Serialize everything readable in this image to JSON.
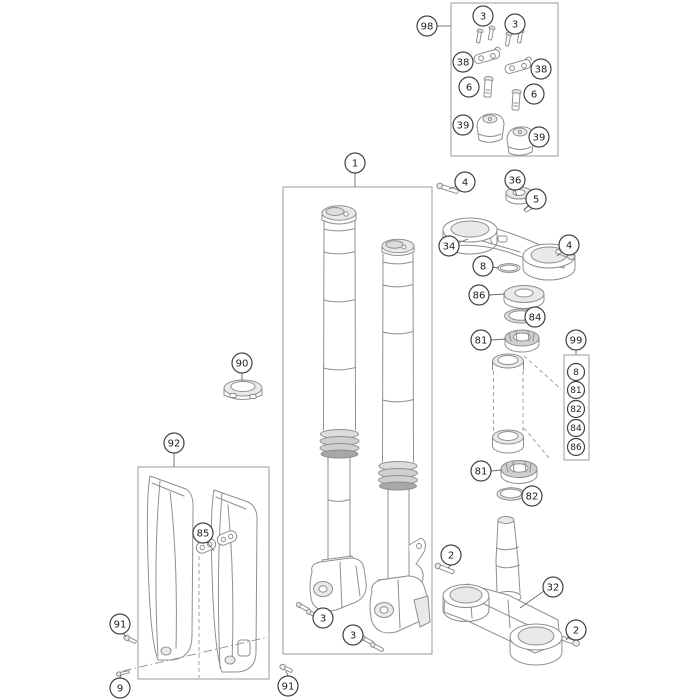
{
  "diagram": {
    "description": "Exploded spare-parts drawing: telescopic front fork, triple clamps, steering-head bearings, handlebar clamp kit and fork protectors",
    "background": "#ffffff",
    "palette": {
      "part_line": "#8f8f8f",
      "box_line": "#9b9b9b",
      "callout_stroke": "#414141",
      "callout_fill": "#ffffff",
      "text": "#1d1d1d",
      "shade_light": "#e9e9e9",
      "shade_mid": "#d0d0d0",
      "shade_dark": "#a7a7a7"
    },
    "group_boxes": [
      {
        "name": "handlebar-clamp-kit-box",
        "x": 451,
        "y": 3,
        "w": 107,
        "h": 153
      },
      {
        "name": "fork-assembly-box",
        "x": 283,
        "y": 187,
        "w": 149,
        "h": 467
      },
      {
        "name": "fork-protector-kit-box",
        "x": 138,
        "y": 467,
        "w": 131,
        "h": 212
      },
      {
        "name": "steering-bearing-kit-box",
        "x": 564,
        "y": 355,
        "w": 25,
        "h": 105
      }
    ],
    "callouts": [
      {
        "label": "98",
        "x": 427,
        "y": 26,
        "r": 10
      },
      {
        "label": "3",
        "x": 483,
        "y": 16,
        "r": 10
      },
      {
        "label": "3",
        "x": 515,
        "y": 24,
        "r": 10
      },
      {
        "label": "38",
        "x": 463,
        "y": 62,
        "r": 10
      },
      {
        "label": "38",
        "x": 541,
        "y": 69,
        "r": 10
      },
      {
        "label": "6",
        "x": 469,
        "y": 87,
        "r": 10
      },
      {
        "label": "6",
        "x": 534,
        "y": 94,
        "r": 10
      },
      {
        "label": "39",
        "x": 463,
        "y": 125,
        "r": 10
      },
      {
        "label": "39",
        "x": 539,
        "y": 137,
        "r": 10
      },
      {
        "label": "1",
        "x": 355,
        "y": 163,
        "r": 10
      },
      {
        "label": "4",
        "x": 465,
        "y": 182,
        "r": 10
      },
      {
        "label": "36",
        "x": 515,
        "y": 180,
        "r": 10
      },
      {
        "label": "5",
        "x": 536,
        "y": 199,
        "r": 10
      },
      {
        "label": "34",
        "x": 449,
        "y": 246,
        "r": 10
      },
      {
        "label": "4",
        "x": 569,
        "y": 245,
        "r": 10
      },
      {
        "label": "8",
        "x": 483,
        "y": 266,
        "r": 10
      },
      {
        "label": "86",
        "x": 479,
        "y": 295,
        "r": 10
      },
      {
        "label": "84",
        "x": 535,
        "y": 317,
        "r": 10
      },
      {
        "label": "81",
        "x": 481,
        "y": 340,
        "r": 10
      },
      {
        "label": "99",
        "x": 576,
        "y": 340,
        "r": 10
      },
      {
        "label": "8",
        "x": 576,
        "y": 372,
        "r": 8.5
      },
      {
        "label": "81",
        "x": 576,
        "y": 390,
        "r": 8.5
      },
      {
        "label": "82",
        "x": 576,
        "y": 409,
        "r": 8.5
      },
      {
        "label": "84",
        "x": 576,
        "y": 428,
        "r": 8.5
      },
      {
        "label": "86",
        "x": 576,
        "y": 447,
        "r": 8.5
      },
      {
        "label": "81",
        "x": 481,
        "y": 471,
        "r": 10
      },
      {
        "label": "82",
        "x": 532,
        "y": 496,
        "r": 10
      },
      {
        "label": "90",
        "x": 242,
        "y": 363,
        "r": 10
      },
      {
        "label": "92",
        "x": 174,
        "y": 443,
        "r": 10
      },
      {
        "label": "85",
        "x": 203,
        "y": 533,
        "r": 10
      },
      {
        "label": "2",
        "x": 451,
        "y": 555,
        "r": 10
      },
      {
        "label": "32",
        "x": 553,
        "y": 587,
        "r": 10
      },
      {
        "label": "2",
        "x": 576,
        "y": 630,
        "r": 10
      },
      {
        "label": "3",
        "x": 323,
        "y": 618,
        "r": 10
      },
      {
        "label": "3",
        "x": 353,
        "y": 635,
        "r": 10
      },
      {
        "label": "91",
        "x": 120,
        "y": 624,
        "r": 10
      },
      {
        "label": "9",
        "x": 120,
        "y": 688,
        "r": 10
      },
      {
        "label": "91",
        "x": 288,
        "y": 686,
        "r": 10
      }
    ],
    "leader_lines": [
      {
        "x1": 437,
        "y1": 26,
        "x2": 451,
        "y2": 26
      },
      {
        "x1": 355,
        "y1": 173,
        "x2": 355,
        "y2": 187
      },
      {
        "x1": 174,
        "y1": 453,
        "x2": 174,
        "y2": 467
      },
      {
        "x1": 576,
        "y1": 350,
        "x2": 576,
        "y2": 355
      },
      {
        "x1": 242,
        "y1": 373,
        "x2": 242,
        "y2": 381
      },
      {
        "x1": 207,
        "y1": 542,
        "x2": 214,
        "y2": 551
      },
      {
        "x1": 457,
        "y1": 186,
        "x2": 449,
        "y2": 189
      },
      {
        "x1": 515,
        "y1": 190,
        "x2": 517,
        "y2": 196
      },
      {
        "x1": 529,
        "y1": 205,
        "x2": 524,
        "y2": 210
      },
      {
        "x1": 458,
        "y1": 243,
        "x2": 468,
        "y2": 239
      },
      {
        "x1": 563,
        "y1": 251,
        "x2": 557,
        "y2": 256
      },
      {
        "x1": 492,
        "y1": 267,
        "x2": 499,
        "y2": 268
      },
      {
        "x1": 489,
        "y1": 295,
        "x2": 505,
        "y2": 294
      },
      {
        "x1": 525,
        "y1": 316,
        "x2": 537,
        "y2": 316
      },
      {
        "x1": 491,
        "y1": 340,
        "x2": 506,
        "y2": 339
      },
      {
        "x1": 491,
        "y1": 471,
        "x2": 502,
        "y2": 470
      },
      {
        "x1": 522,
        "y1": 496,
        "x2": 524,
        "y2": 495
      },
      {
        "x1": 451,
        "y1": 565,
        "x2": 448,
        "y2": 568
      },
      {
        "x1": 544,
        "y1": 591,
        "x2": 520,
        "y2": 608
      },
      {
        "x1": 570,
        "y1": 636,
        "x2": 566,
        "y2": 640
      },
      {
        "x1": 123,
        "y1": 633,
        "x2": 126,
        "y2": 637
      },
      {
        "x1": 120,
        "y1": 678,
        "x2": 121,
        "y2": 675
      },
      {
        "x1": 288,
        "y1": 676,
        "x2": 286,
        "y2": 671
      }
    ],
    "dashed_lines": [
      {
        "x1": 493.5,
        "y1": 371,
        "x2": 493.5,
        "y2": 431
      },
      {
        "x1": 523,
        "y1": 371,
        "x2": 523,
        "y2": 431
      },
      {
        "x1": 524,
        "y1": 356,
        "x2": 561,
        "y2": 389
      },
      {
        "x1": 524,
        "y1": 428,
        "x2": 549,
        "y2": 458
      },
      {
        "x1": 199,
        "y1": 556,
        "x2": 199,
        "y2": 678
      }
    ],
    "dashdot_lines": [
      {
        "x1": 123,
        "y1": 671,
        "x2": 268,
        "y2": 637
      }
    ]
  }
}
